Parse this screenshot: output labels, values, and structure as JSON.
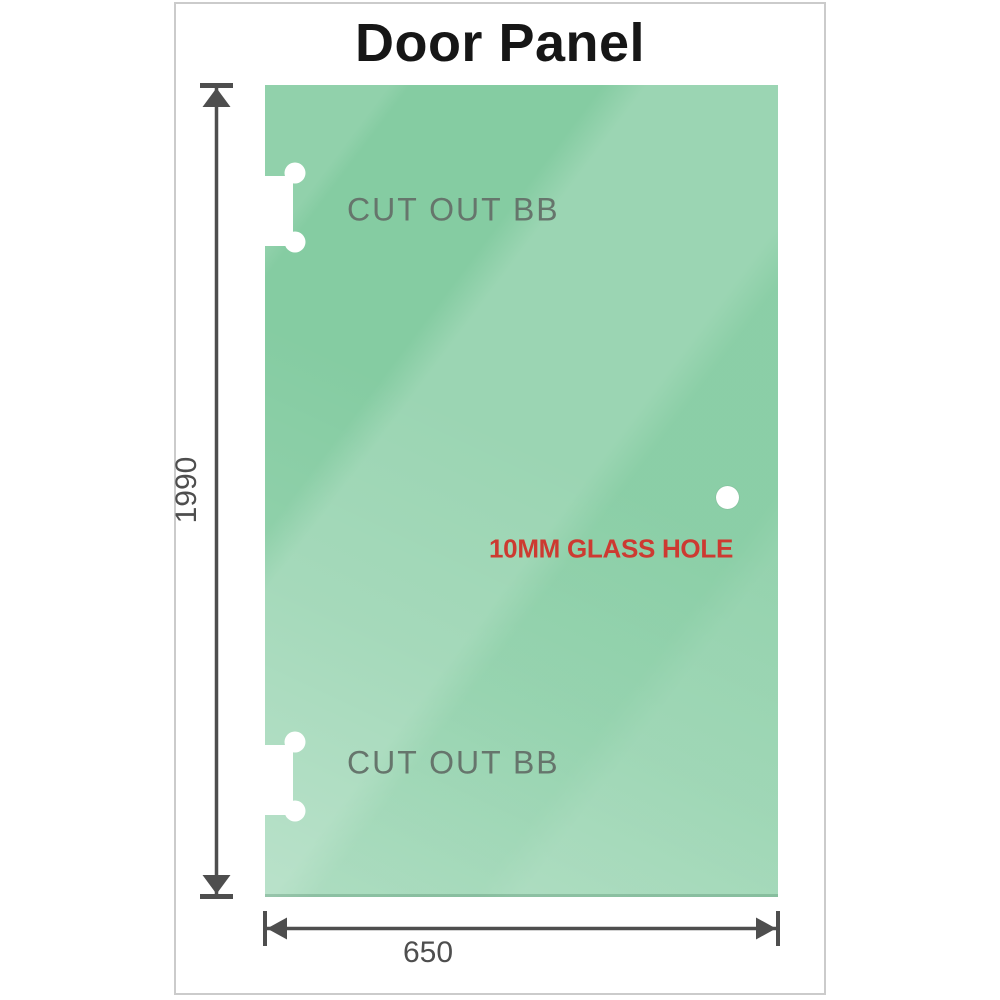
{
  "title": "Door Panel",
  "panel": {
    "cutouts": [
      {
        "label": "CUT OUT BB"
      },
      {
        "label": "CUT OUT BB"
      }
    ],
    "hole": {
      "label": "10MM GLASS HOLE"
    }
  },
  "dimensions": {
    "height": {
      "value": "1990"
    },
    "width": {
      "value": "650"
    }
  },
  "colors": {
    "glass_green": "#85cca2",
    "glass_highlight": "#b5e3c6",
    "cutout_label_gray": "#66756c",
    "hole_label_red": "#cd3a31",
    "dimension_gray": "#4e4e4e",
    "frame_border": "#cbcbcb",
    "title_color": "#161616"
  }
}
